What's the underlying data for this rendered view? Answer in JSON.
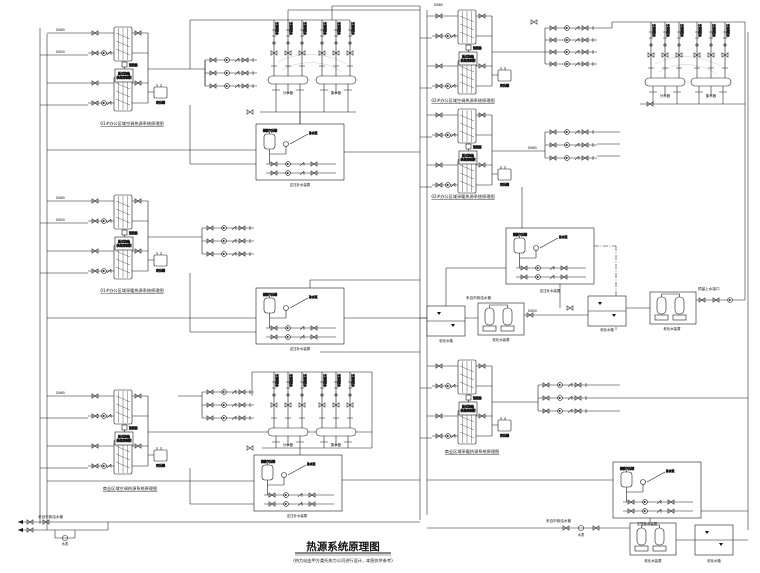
{
  "title": {
    "text": "热源系统原理图",
    "note": "(热力站由甲方委托热力公司进行设计，本图仅供参考)"
  },
  "captions": {
    "left_top": "01#办公区域空调热源系统原理图",
    "left_mid": "01#办公区域采暖热源系统原理图",
    "left_bottom": "商业区域空调热源系统原理图",
    "right_top": "02#办公区域空调热源系统原理图",
    "right_mid": "02#办公区域采暖热源系统原理图",
    "right_bottom": "商业区域采暖热源系统原理图"
  },
  "equipment": {
    "hx_control_line1": "板式换热",
    "hx_control_line2": "机组控制柜",
    "sensor": "温控器",
    "expansion_tank": "定压罐",
    "makeup_unit": "定压补水装置",
    "diaphragm_tank": "隔膜气压罐",
    "makeup_pump": "补水泵",
    "softener": "软化水装置",
    "soft_tank": "软化水箱",
    "manifold_supply": "分水器",
    "manifold_return": "集水器",
    "riser_label": "空调供回水",
    "water_meter": "水表"
  },
  "notes": {
    "city_water": "来自市政给水管",
    "reserved": "预留上水接口"
  },
  "pipe_tags": [
    "DN65",
    "DN50",
    "DN65",
    "DN50",
    "DN65",
    "DN80",
    "DN50",
    "DN65"
  ],
  "colors": {
    "line": "#1a1a1a",
    "faint": "#c8c8c8",
    "bg": "#ffffff"
  }
}
